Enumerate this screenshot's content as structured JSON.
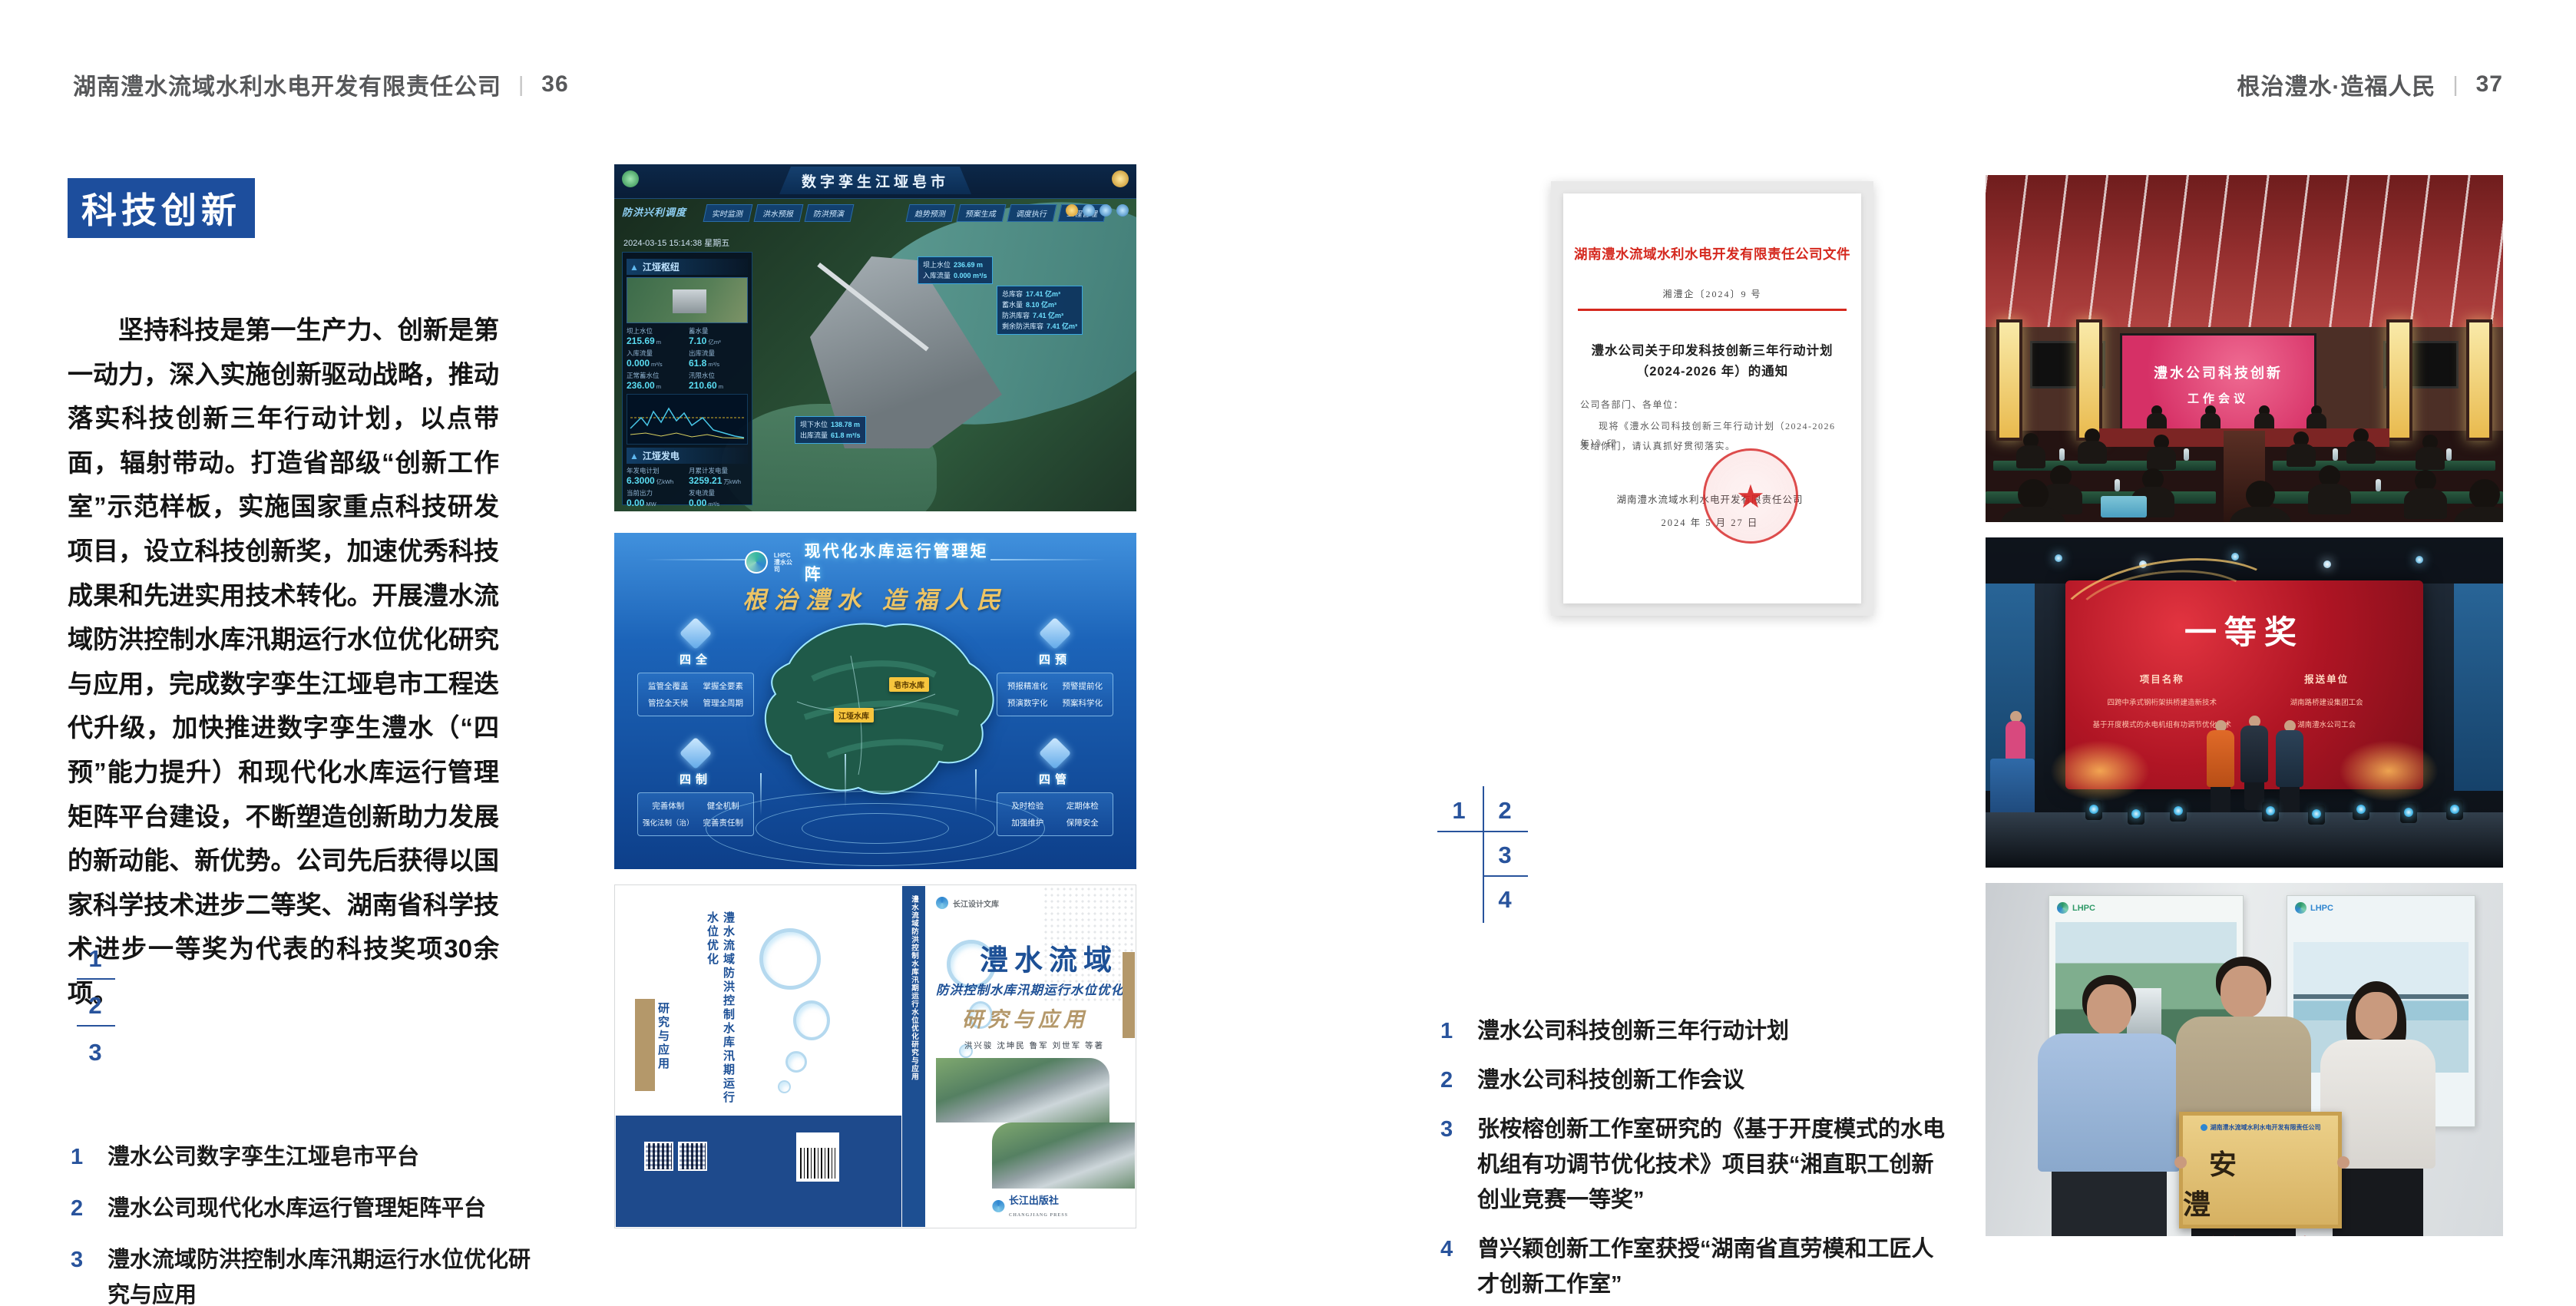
{
  "colors": {
    "accent_blue": "#1d4e9d",
    "navy": "#28539c",
    "doc_red": "#d5281e",
    "book_blue": "#1d5096",
    "tan": "#b4986a",
    "plaque_gold": "#ddbc72",
    "screen_pink": "#d93a69",
    "award_red": "#b61425"
  },
  "left_page": {
    "header": {
      "company": "湖南澧水流域水利水电开发有限责任公司",
      "sep": "|",
      "page": "36"
    },
    "title": "科技创新",
    "paragraph": "坚持科技是第一生产力、创新是第一动力，深入实施创新驱动战略，推动落实科技创新三年行动计划，以点带面，辐射带动。打造省部级“创新工作室”示范样板，实施国家重点科技研发项目，设立科技创新奖，加速优秀科技成果和先进实用技术转化。开展澧水流域防洪控制水库汛期运行水位优化研究与应用，完成数字孪生江垭皂市工程迭代升级，加快推进数字孪生澧水（“四预”能力提升）和现代化水库运行管理矩阵平台建设，不断塑造创新助力发展的新动能、新优势。公司先后获得以国家科学技术进步二等奖、湖南省科学技术进步一等奖为代表的科技奖项30余项。",
    "markers": {
      "m1": "1",
      "m2": "2",
      "m3": "3"
    },
    "captions": [
      {
        "n": "1",
        "t": "澧水公司数字孪生江垭皂市平台"
      },
      {
        "n": "2",
        "t": "澧水公司现代化水库运行管理矩阵平台"
      },
      {
        "n": "3",
        "t": "澧水流域防洪控制水库汛期运行水位优化研究与应用"
      }
    ]
  },
  "right_page": {
    "header": {
      "slogan": "根治澧水·造福人民",
      "sep": "|",
      "page": "37"
    },
    "markers": {
      "m1": "1",
      "m2": "2",
      "m3": "3",
      "m4": "4"
    },
    "captions": [
      {
        "n": "1",
        "t": "澧水公司科技创新三年行动计划"
      },
      {
        "n": "2",
        "t": "澧水公司科技创新工作会议"
      },
      {
        "n": "3",
        "t": "张桉榕创新工作室研究的《基于开度模式的水电机组有功调节优化技术》项目获“湘直职工创新创业竞赛一等奖”"
      },
      {
        "n": "4",
        "t": "曾兴颖创新工作室获授“湖南省直劳模和工匠人才创新工作室”"
      }
    ]
  },
  "fig_twin": {
    "title": "数字孪生江垭皂市",
    "brand": "防洪兴利调度",
    "datetime": "2024-03-15 15:14:38 星期五",
    "tabs_left": [
      "实时监测",
      "洪水预报",
      "防洪预演"
    ],
    "tabs_right": [
      "趋势预测",
      "预案生成",
      "调度执行",
      "工程管理"
    ],
    "panel1": {
      "title": "江垭枢纽",
      "stats": [
        {
          "l": "坝上水位",
          "v": "215.69",
          "u": "m"
        },
        {
          "l": "蓄水量",
          "v": "7.10",
          "u": "亿m³"
        },
        {
          "l": "入库流量",
          "v": "0.000",
          "u": "m³/s"
        },
        {
          "l": "出库流量",
          "v": "61.8",
          "u": "m³/s"
        },
        {
          "l": "正常蓄水位",
          "v": "236.00",
          "u": "m"
        },
        {
          "l": "汛限水位",
          "v": "210.60",
          "u": "m"
        }
      ]
    },
    "panel2": {
      "title": "江垭发电",
      "stats": [
        {
          "l": "年发电计划",
          "v": "6.3000",
          "u": "亿kWh"
        },
        {
          "l": "月累计发电量",
          "v": "3259.21",
          "u": "万kWh"
        },
        {
          "l": "当前出力",
          "v": "0.00",
          "u": "MW"
        },
        {
          "l": "发电流量",
          "v": "0.00",
          "u": "m³/s"
        }
      ]
    },
    "map_tag1": {
      "rows": [
        {
          "l": "坝上水位",
          "v": "236.69 m"
        },
        {
          "l": "入库流量",
          "v": "0.000 m³/s"
        }
      ]
    },
    "map_tag2": {
      "rows": [
        {
          "l": "总库容",
          "v": "17.41 亿m³"
        },
        {
          "l": "蓄水量",
          "v": "8.10 亿m³"
        },
        {
          "l": "防洪库容",
          "v": "7.41 亿m³"
        },
        {
          "l": "剩余防洪库容",
          "v": "7.41 亿m³"
        }
      ]
    },
    "map_tag3": {
      "rows": [
        {
          "l": "坝下水位",
          "v": "138.78 m"
        },
        {
          "l": "出库流量",
          "v": "61.8 m³/s"
        }
      ]
    }
  },
  "fig_matrix": {
    "logo": "LHPC",
    "logo_sub": "澧水公司",
    "title": "现代化水库运行管理矩阵",
    "slogan": "根治澧水 造福人民",
    "groups": [
      {
        "name": "四全",
        "items": [
          "监管全覆盖",
          "掌握全要素",
          "管控全天候",
          "管理全周期"
        ]
      },
      {
        "name": "四预",
        "items": [
          "预报精准化",
          "预警提前化",
          "预演数字化",
          "预案科学化"
        ]
      },
      {
        "name": "四制",
        "items": [
          "完善体制",
          "健全机制",
          "强化法制（治）",
          "完善责任制"
        ]
      },
      {
        "name": "四管",
        "items": [
          "及时检验",
          "定期体检",
          "加强维护",
          "保障安全"
        ]
      }
    ],
    "map_tags": [
      "皂市水库",
      "江垭水库"
    ]
  },
  "fig_book": {
    "series": "长江设计文库",
    "back_title": "澧水流域防洪控制水库汛期运行水位优化",
    "back_tail": "研究与应用",
    "spine_title": "澧水流域防洪控制水库汛期运行水位优化研究与应用",
    "title_region": "澧水流域",
    "title_sub": "防洪控制水库汛期运行水位优化",
    "title_tail": "研究与应用",
    "authors": "洪兴骏  沈坤民  鲁军  刘世军  等著",
    "publisher": "长江出版社",
    "publisher_en": "CHANGJIANG PRESS"
  },
  "fig_doc": {
    "header": "湖南澧水流域水利水电开发有限责任公司文件",
    "doc_no": "湘澧企〔2024〕9 号",
    "title_line1": "澧水公司关于印发科技创新三年行动计划",
    "title_line2": "（2024-2026 年）的通知",
    "salutation": "公司各部门、各单位：",
    "body_line1": "现将《澧水公司科技创新三年行动计划（2024-2026 年）》印",
    "body_line2": "发给你们，请认真抓好贯彻落实。",
    "seal_star": "★",
    "signer": "湖南澧水流域水利水电开发有限责任公司",
    "date": "2024 年 5 月 27 日"
  },
  "fig_meeting": {
    "screen_line1": "澧水公司科技创新",
    "screen_line2": "工作会议"
  },
  "fig_award": {
    "title": "一等奖",
    "col1": "项目名称",
    "col2": "报送单位",
    "rows": [
      {
        "p": "四跨中承式钢桁架拱桥建造新技术",
        "u": "湖南路桥建设集团工会"
      },
      {
        "p": "基于开度模式的水电机组有功调节优化技术",
        "u": "湖南澧水公司工会"
      }
    ]
  },
  "fig_group": {
    "plaque_org": "湖南澧水流域水利水电开发有限责任公司",
    "plaque_title": "安 澧",
    "plaque_sub": "创新工作室",
    "poster_logo": "LHPC"
  }
}
